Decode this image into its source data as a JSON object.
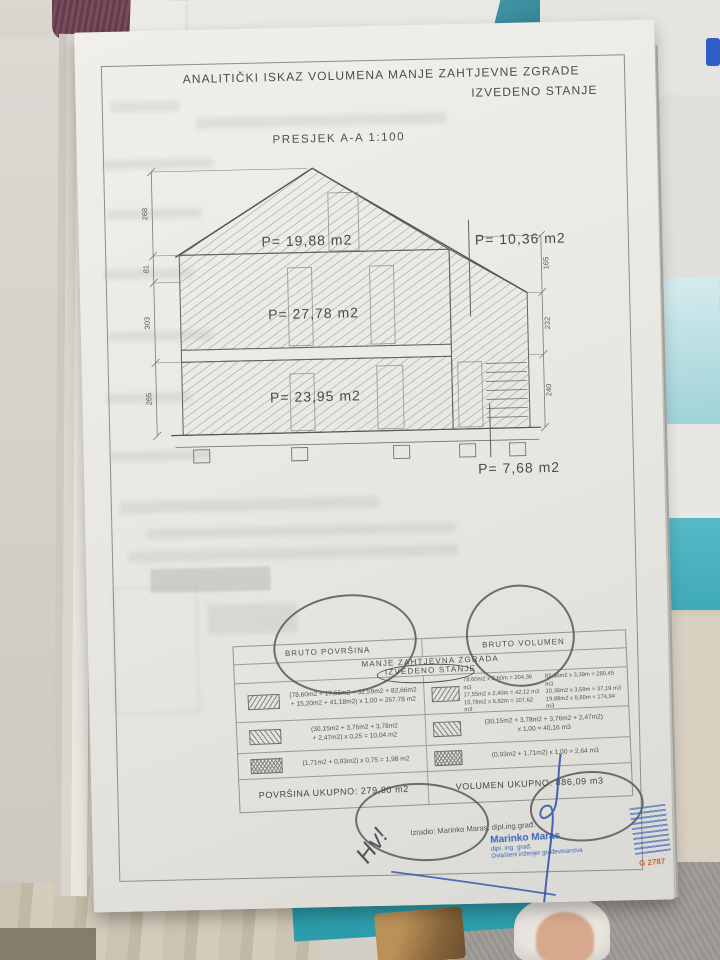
{
  "scene": {
    "package": {
      "brand_gray": "DU",
      "brand_teal": "X",
      "sub_text": "INE"
    },
    "colors": {
      "teal_accent": "#2d9dab",
      "stamp_blue": "#3c66bb",
      "stamp_number_orange": "#c06a38",
      "pen_dark": "#4b4f55",
      "signature_blue": "#2d4fae"
    }
  },
  "document": {
    "title_line1": "ANALITIČKI ISKAZ VOLUMENA MANJE ZAHTJEVNE ZGRADE",
    "title_line2": "IZVEDENO STANJE",
    "section_label": "PRESJEK A-A 1:100",
    "drawing": {
      "area_attic": "P= 19,88 m2",
      "area_leanto_roof": "P= 10,36 m2",
      "area_first_floor": "P= 27,78 m2",
      "area_ground_floor": "P= 23,95 m2",
      "area_leanto": "P= 7,68 m2",
      "dims_left": [
        "268",
        "81",
        "303",
        "265"
      ],
      "dims_right": [
        "165",
        "232",
        "240"
      ]
    },
    "table": {
      "header_left": "BRUTO POVRŠINA",
      "header_right": "BRUTO VOLUMEN",
      "subheader": "MANJE ZAHTJEVNA ZGRADA",
      "subheader2": "IZVEDENO STANJE",
      "rows": [
        {
          "area_line1": "(78,60m2 + 17,55m2 + 32,59m2 + 82,66m2",
          "area_line2": "+ 15,20m2 + 41,18m2) x 1,00 = 267,78 m2",
          "vol_colA": [
            "78,60m2 x 2,60m = 204,36 m3",
            "17,55m2 x 2,40m = 42,12 m3",
            "15,78m2 x 6,82m = 107,62 m3"
          ],
          "vol_colB": [
            "82,66m2 x 3,39m = 280,45 m3",
            "10,36m2 x 3,59m = 37,19 m3",
            "19,88m2 x 8,80m = 174,94 m3"
          ]
        },
        {
          "area_line1": "(30,15m2 + 3,76m2 + 3,78m2",
          "area_line2": "+ 2,47m2) x 0,25 = 10,04 m2",
          "vol_line1": "(30,15m2 + 3,78m2 + 3,76m2 + 2,47m2)",
          "vol_line2": "x 1,00 = 40,16 m3"
        },
        {
          "area_line1": "(1,71m2 + 0,93m2) x 0,75 = 1,98 m2",
          "vol_line1": "(0,93m2 + 1,71m2) x 1,00 = 2,64 m3"
        }
      ],
      "total_area": "POVRŠINA UKUPNO: 279,80 m2",
      "total_volume": "VOLUMEN UKUPNO: 886,09 m3"
    },
    "footer": {
      "author_line": "Izradio: Marinko Maras, dipl.ing.građ.",
      "stamp_name": "Marinko Maras",
      "stamp_title": "dipl. ing. građ.",
      "stamp_role": "Ovlašteni inženjer građevinarstva",
      "stamp_number": "G 2787"
    },
    "handwritten_note": "Hv!"
  }
}
